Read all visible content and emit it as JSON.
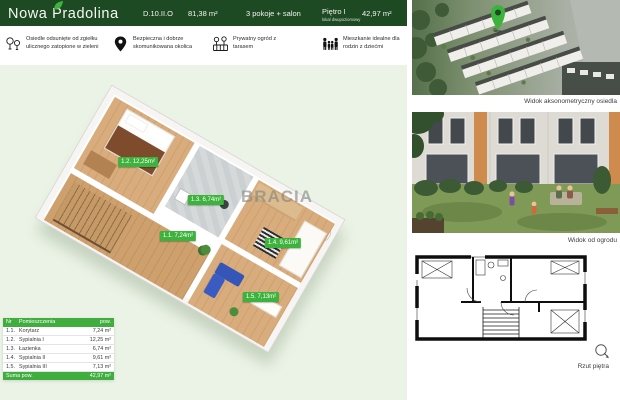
{
  "header": {
    "project_name": "Nowa Pradolina",
    "unit_id": "D.10.II.O",
    "total_area": "81,38 m²",
    "rooms_summary": "3 pokoje + salon",
    "floor": "Piętro I",
    "floor_note": "lokal dwupoziomowy",
    "level_area": "42,97 m²"
  },
  "features": [
    {
      "icon": "trees-icon",
      "text": "Osiedle odsunięte od zgiełku ulicznego zatopione  w zieleni"
    },
    {
      "icon": "map-pin-icon",
      "text": "Bezpieczna i dobrze skomunikowana okolica"
    },
    {
      "icon": "garden-icon",
      "text": "Prywatny ogród z tarasem"
    },
    {
      "icon": "family-icon",
      "text": "Mieszkanie idealne dla rodzin z dziećmi"
    }
  ],
  "plan3d": {
    "watermark": "BRACIA",
    "labels": [
      {
        "text": "1.2. 12,25m²"
      },
      {
        "text": "1.3. 6,74m²"
      },
      {
        "text": "1.1. 7,24m²"
      },
      {
        "text": "1.4. 9,61m²"
      },
      {
        "text": "1.5. 7,13m²"
      }
    ]
  },
  "room_table": {
    "col_nr": "Nr",
    "col_name": "Pomieszczenia",
    "col_area": "pow.",
    "rows": [
      {
        "nr": "1.1.",
        "name": "Korytarz",
        "area": "7,24 m²"
      },
      {
        "nr": "1.2.",
        "name": "Sypialnia I",
        "area": "12,25 m²"
      },
      {
        "nr": "1.3.",
        "name": "Łazienka",
        "area": "6,74 m²"
      },
      {
        "nr": "1.4.",
        "name": "Sypialnia II",
        "area": "9,61 m²"
      },
      {
        "nr": "1.5.",
        "name": "Sypialnia III",
        "area": "7,13 m²"
      }
    ],
    "total_label": "Suma pow.",
    "total_value": "42,97 m²"
  },
  "sidebar": {
    "caption_aerial": "Widok aksonometryczny osiedla",
    "caption_garden": "Widok od ogrodu",
    "caption_plan": "Rzut piętra"
  },
  "colors": {
    "brand_dark_green": "#1d4a22",
    "brand_green": "#3db33d",
    "plan_bg_mint": "#ebf3e6"
  }
}
